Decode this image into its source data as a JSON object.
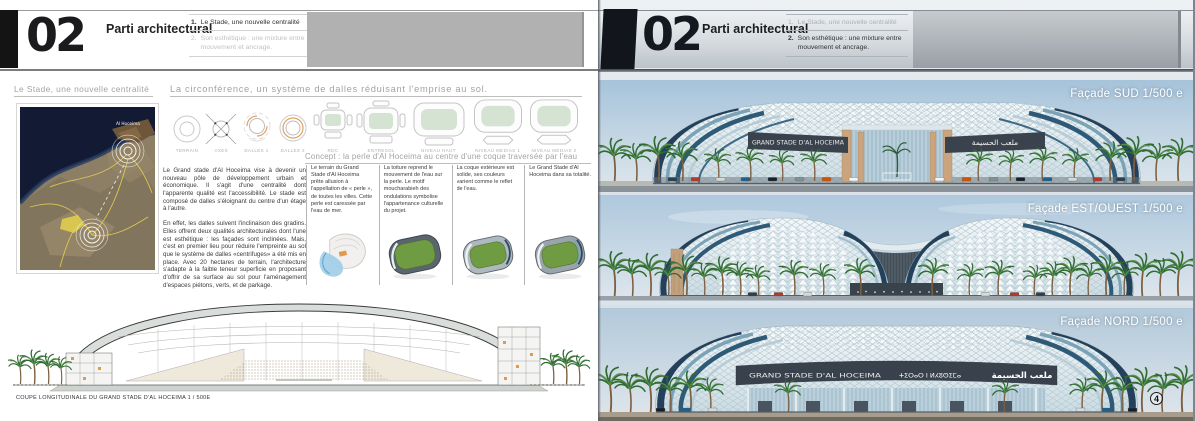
{
  "header": {
    "number": "02",
    "title": "Parti architectural",
    "item1_num": "1.",
    "item1": "Le Stade, une nouvelle centralité",
    "item2_num": "2.",
    "item2": "Son esthétique : une mixture entre mouvement et ancrage."
  },
  "left": {
    "section1_title": "Le Stade, une nouvelle centralité",
    "map_label": "Al Hoceima",
    "section2_title": "La circonférence, un système de dalles réduisant l'emprise au sol.",
    "diagram_labels": [
      "TERRAIN",
      "AXES",
      "DALLES 1",
      "DALLES 2",
      "RDC",
      "ENTRESOL",
      "NIVEAU HAUT",
      "NIVEAU MEDIAS 1",
      "NIVEAU MEDIAS 2"
    ],
    "concept_title": "Concept : la perle d'Al Hoceima au centre d'une coque traversée par l'eau",
    "para1": "Le Grand stade d'Al Hoceima vise à devenir un nouveau pôle de développement urbain et économique. Il s'agit d'une centralité dont l'apparente qualité est l'accessibilité. Le stade est composé de dalles s'éloignant du centre d'un étage à l'autre.",
    "para2": "En effet, les dalles suivent l'inclinaison des gradins. Elles offrent deux qualités architecturales dont l'une est esthétique : les façades sont inclinées. Mais, c'est en premier lieu pour réduire l'empreinte au sol que le système de dalles «centrifuges» a été mis en place. Avec 20 hectares de terrain, l'architecture s'adapte à la faible teneur superficie en proposant d'offrir de sa surface au sol pour l'aménagement d'espaces piétons, verts, et de parkage.",
    "concept_boxes": [
      "Le terrain du Grand Stade d'Al Hoceima prête allusion à l'appellation de « perle », de toutes les villes. Cette perle est caressée par l'eau de mer.",
      "La toiture reprend le mouvement de l'eau sur la perle. Le motif moucharabieh des ondulations symbolise l'appartenance culturelle du projet.",
      "La coque extérieure est solide, ses couleurs varient comme le reflet de l'eau.",
      "Le Grand Stade d'Al Hoceima dans sa totalité."
    ],
    "section_caption": "COUPE LONGITUDINALE DU GRAND STADE D'AL HOCEIMA 1 / 500E"
  },
  "right": {
    "renders": [
      {
        "label": "Façade SUD 1/500 e",
        "banner_latin": "GRAND STADE D'AL HOCEIMA",
        "banner_arabic": "ملعب الحسيمة"
      },
      {
        "label": "Façade EST/OUEST 1/500 e"
      },
      {
        "label": "Façade NORD 1/500 e",
        "banner_latin": "GRAND STADE D'AL HOCEIMA",
        "banner_tifinagh": "ⵜⵉⵔⴰⵔ ⵏ ⵍⵃⵓⵙⵉⵎⴰ",
        "banner_arabic": "ملعب الحسيمة"
      }
    ],
    "page_number": "4"
  },
  "colors": {
    "accent_orange": "#dfa263",
    "field_green": "#6f9c42",
    "slab_green": "#d5e3d3",
    "banner_dark": "#39424c",
    "sea_navy": "#141c33",
    "sky_blue": "#aec8dc",
    "header_gray": "#b1b1b1"
  }
}
